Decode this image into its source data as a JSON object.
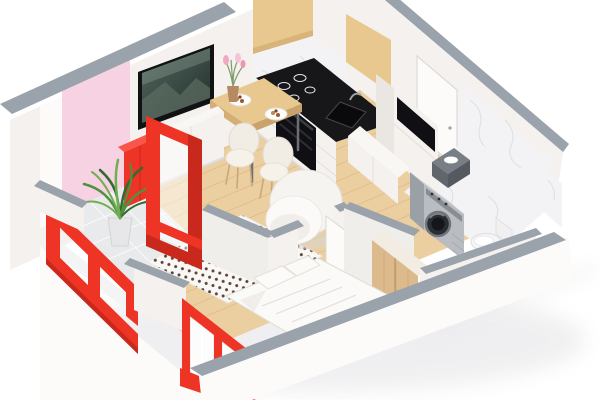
{
  "meta": {
    "description": "3D isometric cutaway floor plan render of a small studio apartment, bird's-eye view on white background",
    "render_style": "photorealistic axonometric dollhouse view"
  },
  "palette": {
    "background": "#ffffff",
    "wall_cap": "#9aa2ac",
    "wall_cap_light": "#b6bcc4",
    "wall_white": "#f4f1ee",
    "wall_white_bright": "#fcfbfa",
    "wall_white_shade": "#eae7e3",
    "wall_inner_shade": "#f0eeea",
    "pink_wall": "#f6d2e2",
    "accent_red": "#ee3424",
    "accent_red_dark": "#c9281c",
    "accent_red_light": "#f8564a",
    "wood_floor": "#eccfa0",
    "wood_floor_line": "#d7b384",
    "wood_cabinet": "#e8c88f",
    "wood_cabinet_shade": "#d8b478",
    "wood_wardrobe": "#ddba8c",
    "marble": "#f3f3f5",
    "marble_vein": "#d9dae0",
    "tile": "#e9eaec",
    "black": "#17171a",
    "dark_gray": "#3c4046",
    "silver": "#b9bdc2",
    "silver_light": "#ced2d6",
    "silver_dark": "#9aa0a6",
    "white_furniture": "#f8f7f4",
    "white_furniture_shade": "#e7e4df",
    "chair_white": "#f1ede5",
    "chair_leg": "#c8a878",
    "rug_white": "#faf8f4",
    "rug_dot": "#4a2c26",
    "blanket_pink": "#f2b7c6",
    "bedding_white": "#fafaf7",
    "bedding_shade": "#e1ded8",
    "toilet_white": "#f6f6f6",
    "flower_pink": "#f0a9c0",
    "plant_green_dark": "#2f6b33",
    "plant_green": "#4f9140",
    "plant_green_light": "#71ad52",
    "tv_screen_dark": "#2c3a36",
    "tv_screen_mid": "#44544d",
    "tv_screen_light": "#8fa59b"
  },
  "scene": {
    "type": "isometric-3d-floor-plan",
    "rooms": [
      {
        "name": "living-room-kitchen",
        "contents": [
          "wall-tv",
          "tv-stand",
          "red-sideboard",
          "dining-table",
          "two-dining-chairs",
          "vase-with-tulips",
          "dinner-plates",
          "dotted-rug",
          "pink-blanket",
          "round-armchair",
          "kitchen-upper-cabinets",
          "marble-backsplash",
          "black-cooktop",
          "built-in-oven",
          "black-sink",
          "white-counter-drawers",
          "tall-cabinet",
          "low-cabinet"
        ]
      },
      {
        "name": "balcony",
        "contents": [
          "palm-plant",
          "tile-floor",
          "red-glazed-partition",
          "red-window-frame"
        ]
      },
      {
        "name": "bedroom",
        "contents": [
          "double-bed",
          "pillows",
          "rumpled-blanket",
          "red-framed-windows"
        ]
      },
      {
        "name": "hallway",
        "contents": [
          "wood-wardrobe",
          "open-white-door"
        ]
      },
      {
        "name": "bathroom",
        "contents": [
          "washing-machine",
          "laundry-basket-with-towels",
          "toilet",
          "marble-floor",
          "marble-wall",
          "entry-door"
        ]
      }
    ],
    "finishes": {
      "exterior_walls": "white",
      "wall_tops": "gray",
      "accent_wall": "pink",
      "frames": "red",
      "floor_main": "light wood",
      "floor_wet_areas": "white marble tile"
    }
  }
}
